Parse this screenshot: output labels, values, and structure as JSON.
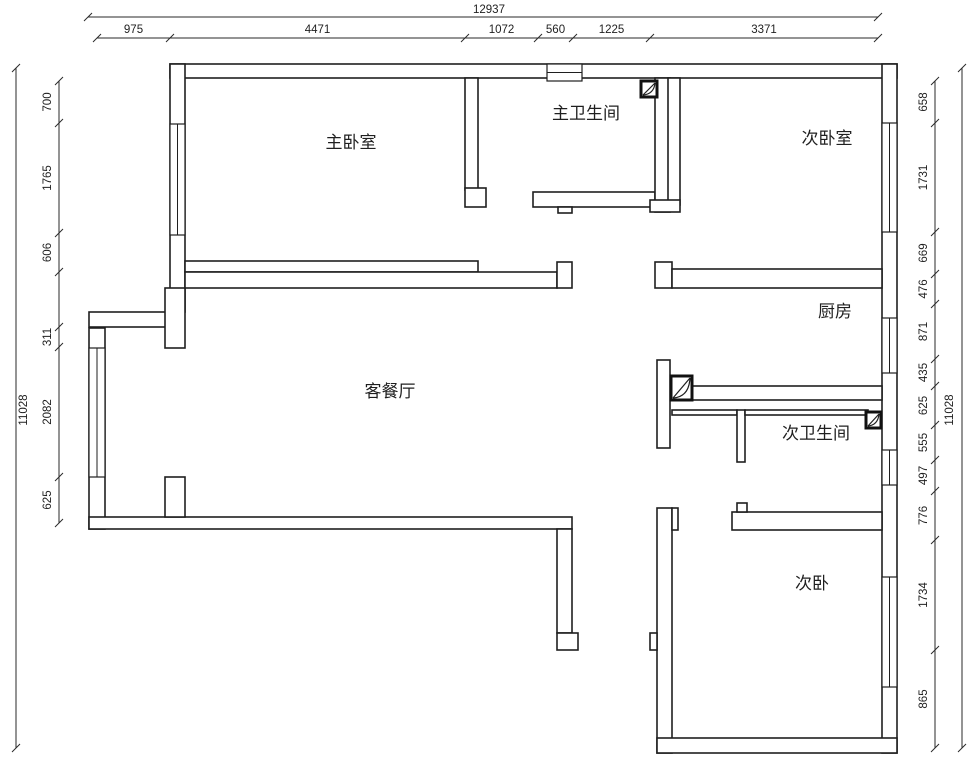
{
  "drawing": {
    "line_color": "#1f1f1f",
    "background": "#ffffff",
    "rooms": [
      {
        "id": "master-bedroom",
        "label": "主卧室",
        "x": 351,
        "y": 148
      },
      {
        "id": "master-bathroom",
        "label": "主卫生间",
        "x": 586,
        "y": 119
      },
      {
        "id": "second-bedroom",
        "label": "次卧室",
        "x": 827,
        "y": 144
      },
      {
        "id": "kitchen",
        "label": "厨房",
        "x": 835,
        "y": 317
      },
      {
        "id": "living-dining-room",
        "label": "客餐厅",
        "x": 390,
        "y": 397
      },
      {
        "id": "second-bathroom",
        "label": "次卫生间",
        "x": 816,
        "y": 439
      },
      {
        "id": "second-bedroom-south",
        "label": "次卧",
        "x": 812,
        "y": 589
      }
    ],
    "walls": [
      [
        170,
        64,
        727,
        14
      ],
      [
        882,
        64,
        15,
        689
      ],
      [
        170,
        64,
        15,
        248
      ],
      [
        89,
        312,
        81,
        15
      ],
      [
        165,
        288,
        20,
        60
      ],
      [
        89,
        328,
        16,
        201
      ],
      [
        89,
        517,
        483,
        12
      ],
      [
        165,
        477,
        20,
        40
      ],
      [
        557,
        529,
        15,
        104
      ],
      [
        557,
        633,
        21,
        17
      ],
      [
        465,
        78,
        13,
        112
      ],
      [
        465,
        188,
        21,
        19
      ],
      [
        533,
        192,
        122,
        15
      ],
      [
        558,
        207,
        14,
        6
      ],
      [
        655,
        78,
        15,
        134
      ],
      [
        668,
        78,
        12,
        127
      ],
      [
        650,
        200,
        30,
        12
      ],
      [
        185,
        261,
        293,
        11
      ],
      [
        185,
        272,
        372,
        16
      ],
      [
        557,
        262,
        15,
        26
      ],
      [
        655,
        262,
        17,
        26
      ],
      [
        672,
        269,
        210,
        19
      ],
      [
        657,
        360,
        13,
        88
      ],
      [
        692,
        386,
        190,
        14
      ],
      [
        672,
        410,
        65,
        5
      ],
      [
        737,
        410,
        8,
        52
      ],
      [
        745,
        410,
        123,
        5
      ],
      [
        732,
        512,
        150,
        18
      ],
      [
        737,
        503,
        10,
        9
      ],
      [
        657,
        508,
        15,
        245
      ],
      [
        672,
        508,
        6,
        22
      ],
      [
        650,
        633,
        7,
        17
      ],
      [
        657,
        738,
        240,
        15
      ]
    ],
    "windows": [
      [
        170,
        124,
        15,
        111,
        "v"
      ],
      [
        89,
        348,
        16,
        129,
        "v"
      ],
      [
        547,
        64,
        35,
        17,
        "h"
      ],
      [
        882,
        123,
        15,
        109,
        "v"
      ],
      [
        882,
        318,
        15,
        55,
        "v"
      ],
      [
        882,
        450,
        15,
        35,
        "v"
      ],
      [
        882,
        577,
        15,
        110,
        "v"
      ]
    ],
    "flues": [
      [
        641,
        81,
        16,
        16
      ],
      [
        671,
        376,
        21,
        24
      ],
      [
        866,
        412,
        15,
        16
      ]
    ],
    "dimensions": {
      "top": {
        "overall": {
          "label": "12937",
          "line_y": 17,
          "start": 88,
          "end": 878,
          "text_x": 489,
          "text_y": 13
        },
        "chain": {
          "line_y": 38,
          "text_offset": -5,
          "boundaries": [
            97,
            170,
            465,
            538,
            573,
            650,
            878
          ],
          "labels": [
            "975",
            "4471",
            "1072",
            "560",
            "1225",
            "3371"
          ]
        }
      },
      "left": {
        "overall": {
          "label": "11028",
          "line_x": 16,
          "start": 68,
          "end": 748,
          "text_x": 27,
          "text_y": 410
        },
        "chain": {
          "line_x": 59,
          "text_offset": -8,
          "boundaries": [
            81,
            123,
            233,
            272,
            327,
            347,
            477,
            523
          ],
          "labels": [
            "700",
            "1765",
            "606",
            "",
            "311",
            "2082",
            "625"
          ]
        }
      },
      "right": {
        "overall": {
          "label": "11028",
          "line_x": 962,
          "start": 68,
          "end": 748,
          "text_x": 953,
          "text_y": 410
        },
        "chain": {
          "line_x": 935,
          "text_offset": -8,
          "boundaries": [
            81,
            123,
            232,
            274,
            304,
            359,
            386,
            425,
            460,
            491,
            540,
            650,
            748
          ],
          "labels": [
            "658",
            "1731",
            "669",
            "476",
            "871",
            "435",
            "625",
            "555",
            "497",
            "776",
            "1734",
            "865"
          ]
        }
      }
    }
  }
}
